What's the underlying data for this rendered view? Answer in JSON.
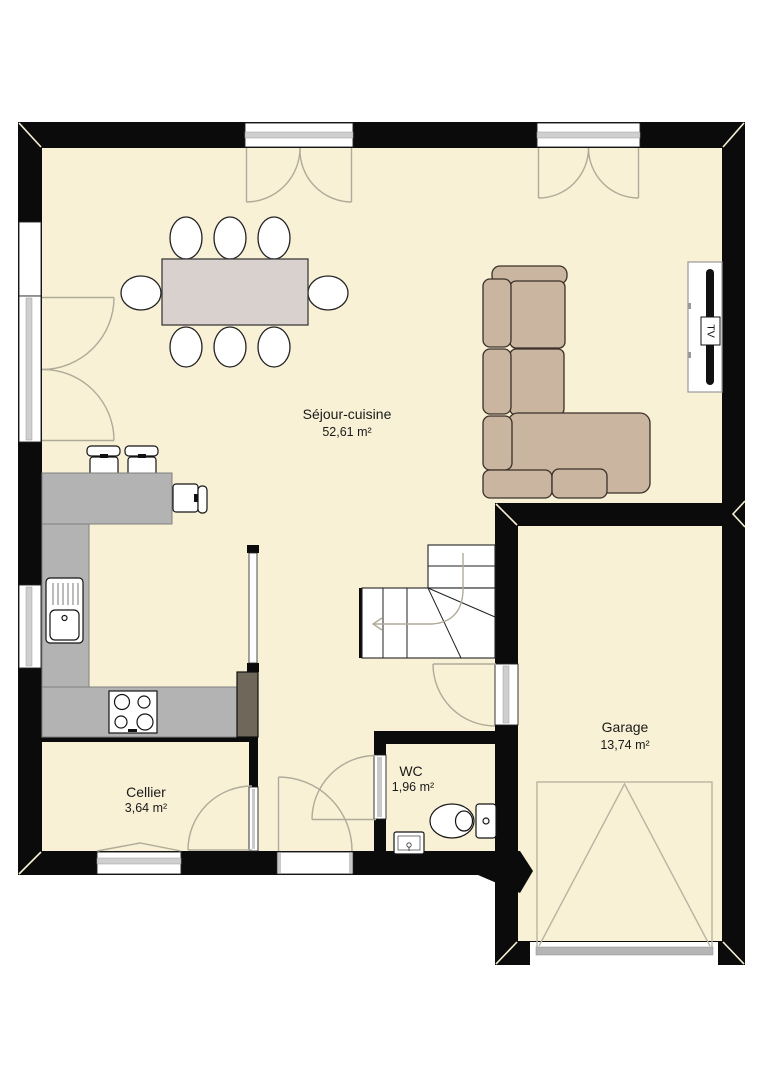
{
  "colors": {
    "floor": "#f8f1d6",
    "wall": "#0b0b0b",
    "counter": "#b3b3b3",
    "sofa": "#c9b5a0",
    "sofa-outline": "#3a3028",
    "table": "#d9d1cd",
    "door-arc": "#b0aa99",
    "cabinet": "#6f6759",
    "glaze": "#cfcfcf",
    "label": "#1a1a1a"
  },
  "rooms": [
    {
      "name": "Séjour-cuisine",
      "area": "52,61 m²"
    },
    {
      "name": "Garage",
      "area": "13,74 m²"
    },
    {
      "name": "WC",
      "area": "1,96 m²"
    },
    {
      "name": "Cellier",
      "area": "3,64 m²"
    }
  ],
  "tv_label": "TV"
}
